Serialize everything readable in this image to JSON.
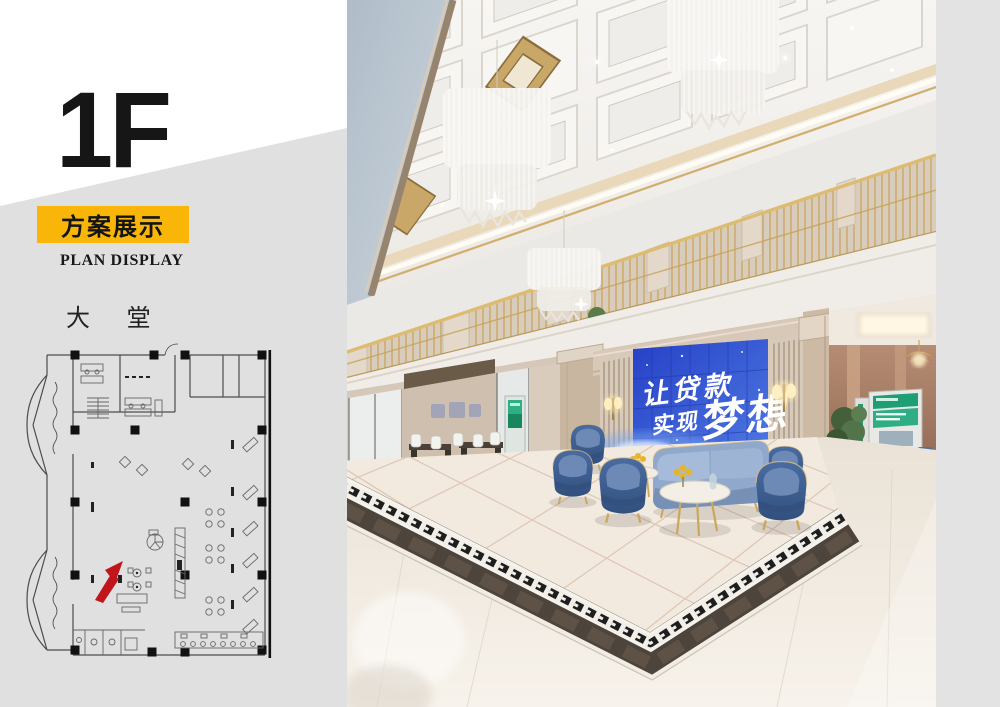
{
  "page": {
    "background": "#ffffff",
    "right_strip_color": "#E3E3E3"
  },
  "left_panel": {
    "floor_label": "1F",
    "banner": {
      "text": "方案展示",
      "bg_color": "#F9B508",
      "text_color": "#141414"
    },
    "subtitle": "PLAN DISPLAY",
    "area_label": "大 堂",
    "wedge_color": "#E0E0E0",
    "floorplan": {
      "north_arrow_color": "#C0151B",
      "wall_color": "#4c4c4c",
      "column_color": "#111111"
    }
  },
  "rendering": {
    "screen": {
      "line1": "让贷款",
      "line2": "实现",
      "line3": "梦想",
      "text_color": "#ffffff",
      "panel_top_color": "#2540C6",
      "panel_bottom_color": "#4F7BE4"
    },
    "palette": {
      "ceiling": "#F5F3EF",
      "upper_wall": "#B6C2CC",
      "marble": "#D7C9B9",
      "gold": "#C9A35C",
      "armchair_navy": "#3D5F93",
      "sofa_blue": "#8FA8CC",
      "floor": "#EFE8DE",
      "border_wood": "#4D443B",
      "atm_green": "#1F9E76"
    }
  }
}
